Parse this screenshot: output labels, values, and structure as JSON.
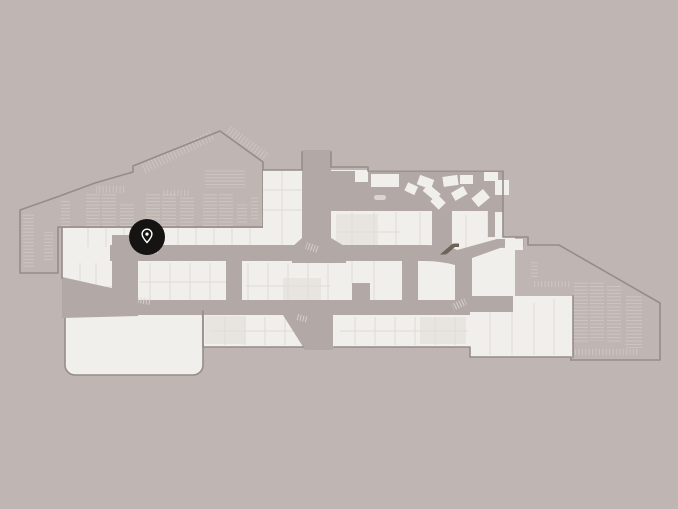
{
  "app": {
    "view": "indoor-mall-floor-map"
  },
  "map": {
    "marker": {
      "x": 147,
      "y": 237,
      "icon": "location-pin-icon"
    },
    "regions": [
      "parking-northwest",
      "parking-southeast",
      "mall-building",
      "central-plaza",
      "walkway-network",
      "anchor-store"
    ],
    "icons": [
      {
        "name": "location-pin-icon",
        "glyph": "map-marker-outline"
      },
      {
        "name": "escalator-icon",
        "glyph": "escalator"
      }
    ],
    "colors": {
      "background": "#bfb5b2",
      "walkway": "#b2a8a5",
      "building": "#f0efec",
      "building_alt": "#e8e4e0",
      "partition": "#dfdbd6",
      "boundary": "#968c88",
      "parking_stripe": "#cfc7c3",
      "escalator_mark": "#dad5d1",
      "escalator_icon": "#6f6258",
      "marker_bg": "#161413",
      "marker_glyph": "#ffffff"
    }
  }
}
